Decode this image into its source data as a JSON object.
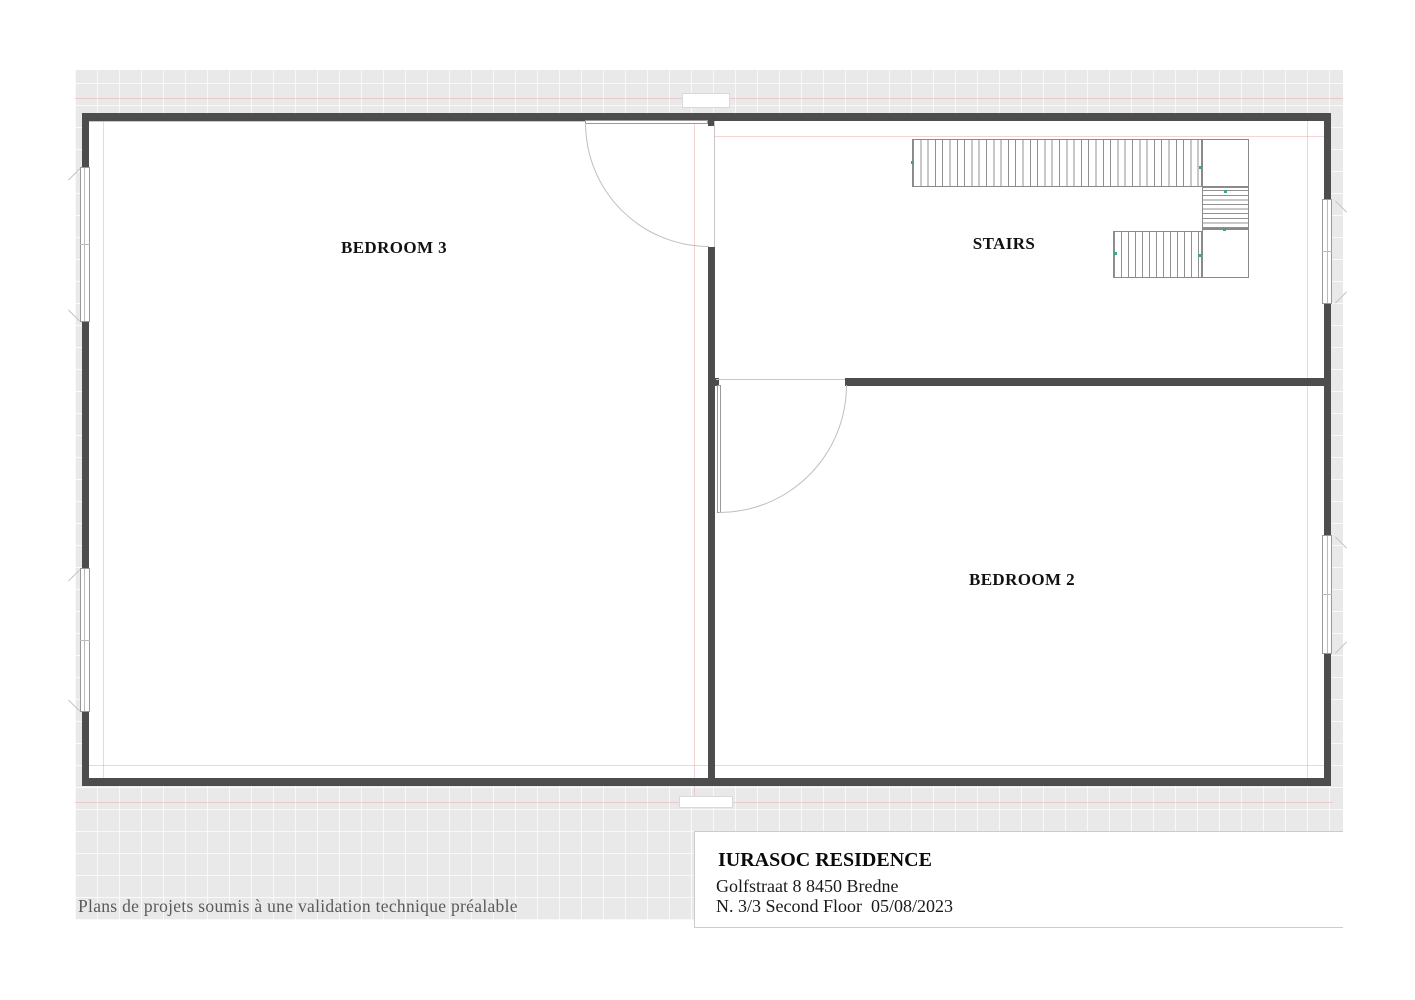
{
  "plan": {
    "labels": {
      "bedroom3": "BEDROOM 3",
      "stairs": "STAIRS",
      "bedroom2": "BEDROOM 2"
    },
    "title_block": {
      "name": "IURASOC RESIDENCE",
      "address": "Golfstraat 8 8450 Bredne",
      "floor_line": "N. 3/3 Second Floor  05/08/2023"
    },
    "footnote": "Plans de projets soumis à une validation technique préalable"
  },
  "colors": {
    "wall": "#4d4d4d",
    "paper": "#e9e9e9",
    "guide_pink": "#eaa9a9",
    "tick_green": "#43a18c",
    "text": "#111111",
    "footnote_text": "#5a5a5a"
  }
}
